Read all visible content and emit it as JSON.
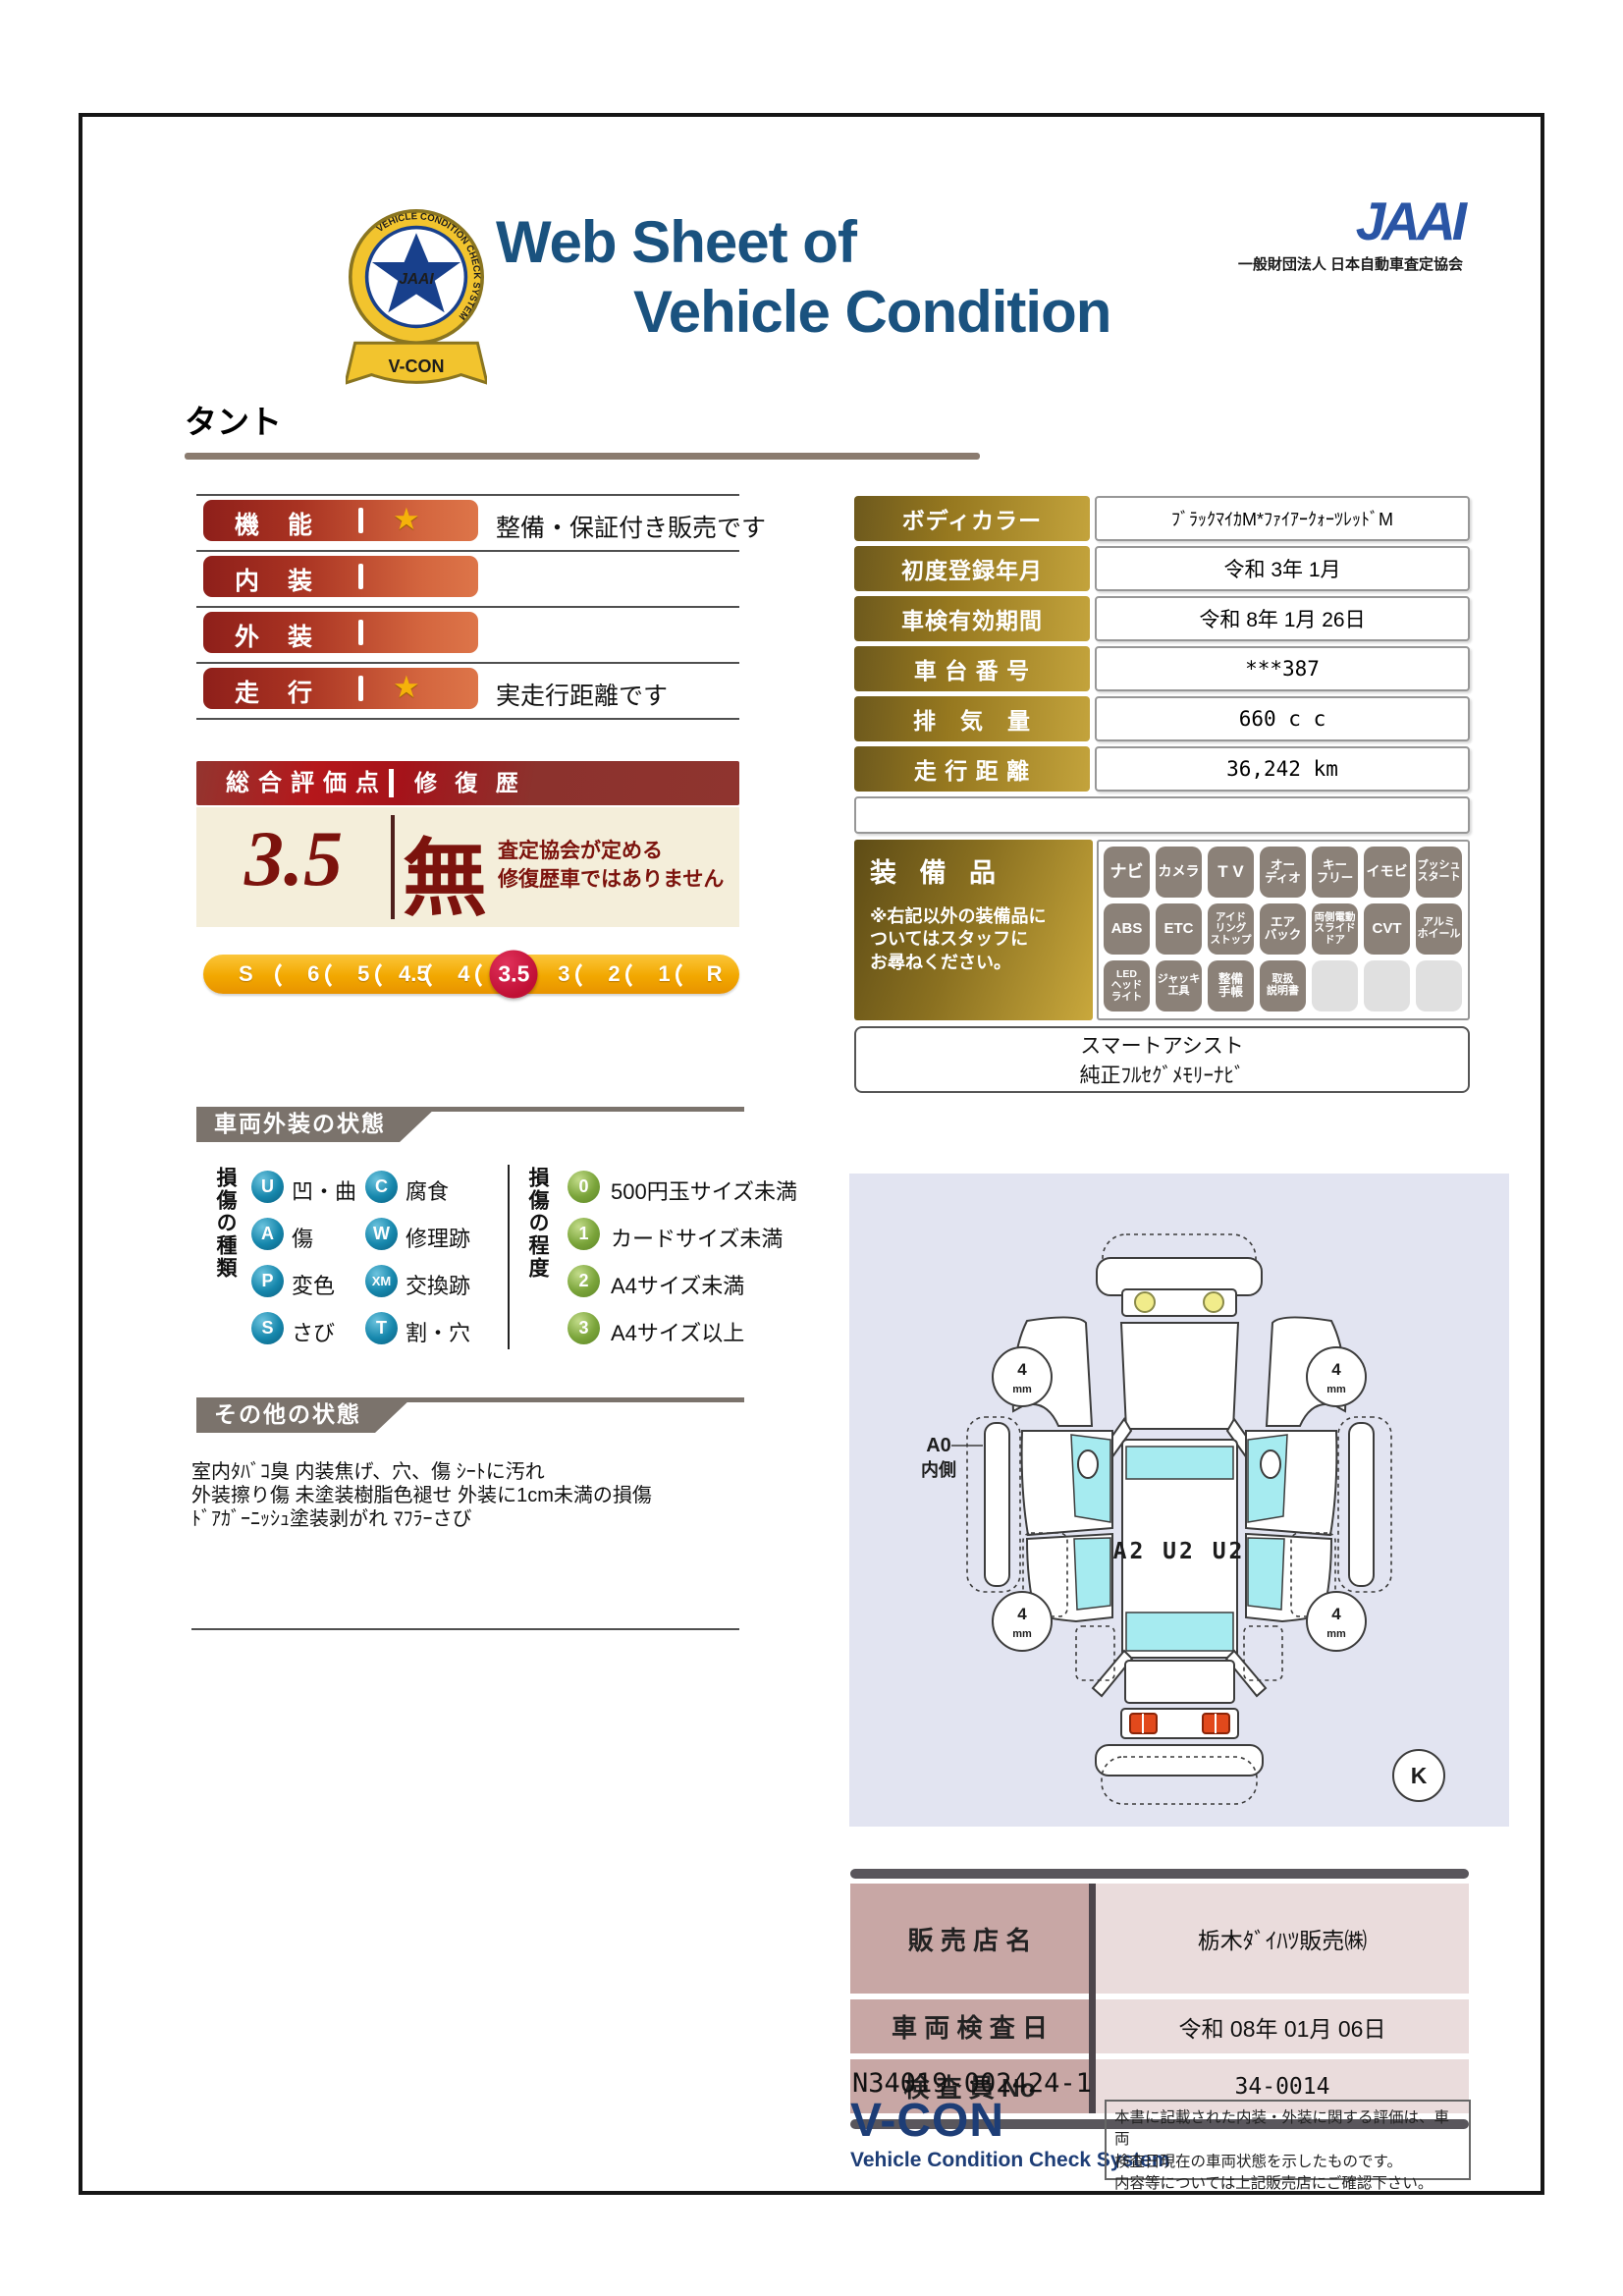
{
  "icons": {
    "star": "★"
  },
  "colors": {
    "title_navy": "#1a527f",
    "bar_red": "#a93322",
    "gold_label": "#96781f",
    "crimson_active": "#c00f35",
    "maroon_score": "#7c130d",
    "diagram_bg": "#e2e4f1",
    "flag_gray": "#7b736c"
  },
  "header": {
    "title_line1": "Web Sheet of",
    "title_line2": "Vehicle Condition",
    "emblem": {
      "ring_text": "VEHICLE CONDITION CHECK SYSTEM",
      "word": "JAAI",
      "ribbon": "V-CON"
    },
    "org_mark": "JAAI",
    "org_name": "一般財団法人 日本自動車査定協会"
  },
  "vehicle_name": "タント",
  "ratings": {
    "rows": [
      {
        "label": "機　能",
        "star": true,
        "note": "整備・保証付き販売です"
      },
      {
        "label": "内　装",
        "star": false,
        "note": ""
      },
      {
        "label": "外　装",
        "star": false,
        "note": ""
      },
      {
        "label": "走　行",
        "star": true,
        "note": "実走行距離です"
      }
    ]
  },
  "overall": {
    "header_left": "総合評価点",
    "header_right": "修 復 歴",
    "score": "3.5",
    "repair_mark": "無",
    "repair_note1": "査定協会が定める",
    "repair_note2": "修復歴車ではありません"
  },
  "scale": {
    "values": [
      "S",
      "6",
      "5",
      "4.5",
      "4",
      "3.5",
      "3",
      "2",
      "1",
      "R"
    ],
    "active": "3.5"
  },
  "info_table": {
    "rows": [
      {
        "label": "ボディカラー",
        "value": "ﾌﾞﾗｯｸﾏｲｶM*ﾌｧｲｱｰｸｫｰﾂﾚｯﾄﾞM"
      },
      {
        "label": "初度登録年月",
        "value": "令和 3年 1月"
      },
      {
        "label": "車検有効期間",
        "value": "令和 8年 1月 26日"
      },
      {
        "label": "車 台 番 号",
        "value": "***387"
      },
      {
        "label": "排　気　量",
        "value": "660 c c"
      },
      {
        "label": "走 行 距 離",
        "value": "36,242 km"
      }
    ]
  },
  "equipment": {
    "title": "装 備 品",
    "note": "※右記以外の装備品に\nついてはスタッフに\nお尋ねください。",
    "rows": [
      [
        "ナビ",
        "カメラ",
        "T V",
        "オー\nディオ",
        "キー\nフリー",
        "イモビ",
        "プッシュ\nスタート"
      ],
      [
        "ABS",
        "ETC",
        "アイド\nリング\nストップ",
        "エア\nバック",
        "両側電動\nスライド\nドア",
        "CVT",
        "アルミ\nホイール"
      ],
      [
        "LED\nヘッド\nライト",
        "ジャッキ\n工具",
        "整備\n手帳",
        "取扱\n説明書",
        "",
        "",
        ""
      ]
    ],
    "smart_line1": "スマートアシスト",
    "smart_line2": "純正ﾌﾙｾｸﾞﾒﾓﾘｰﾅﾋﾞ"
  },
  "exterior": {
    "title": "車両外装の状態",
    "type_header": "損傷の種類",
    "types": [
      {
        "code": "U",
        "label": "凹・曲"
      },
      {
        "code": "A",
        "label": "傷"
      },
      {
        "code": "P",
        "label": "変色"
      },
      {
        "code": "S",
        "label": "さび"
      },
      {
        "code": "C",
        "label": "腐食"
      },
      {
        "code": "W",
        "label": "修理跡"
      },
      {
        "code": "XM",
        "label": "交換跡"
      },
      {
        "code": "T",
        "label": "割・穴"
      }
    ],
    "degree_header": "損傷の程度",
    "degrees": [
      {
        "code": "0",
        "label": "500円玉サイズ未満"
      },
      {
        "code": "1",
        "label": "カードサイズ未満"
      },
      {
        "code": "2",
        "label": "A4サイズ未満"
      },
      {
        "code": "3",
        "label": "A4サイズ以上"
      }
    ]
  },
  "other": {
    "title": "その他の状態",
    "lines": [
      "室内ﾀﾊﾞｺ臭 内装焦げ、穴、傷 ｼｰﾄに汚れ",
      "外装擦り傷 未塗装樹脂色褪せ 外装に1cm未満の損傷",
      "ﾄﾞｱｶﾞｰﾆｯｼｭ塗装剥がれ ﾏﾌﾗｰさび"
    ]
  },
  "diagram": {
    "damage_text": "A2 U2 U2",
    "side_label1": "A0",
    "side_label2": "内側",
    "tire_value": "4",
    "tire_unit": "mm",
    "corner_mark": "K"
  },
  "dealer": {
    "rows": [
      {
        "label": "販 売 店 名",
        "value": "栃木ﾀﾞｲﾊﾂ販売㈱"
      },
      {
        "label": "車 両 検 査 日",
        "value": "令和 08年 01月 06日"
      },
      {
        "label": "検 査 員 No",
        "value": "34-0014"
      }
    ]
  },
  "footer": {
    "serial": "N34019-002424-1",
    "vcon": "V-CON",
    "vcon_sub": "Vehicle Condition Check System",
    "disclaimer": [
      "本書に記載された内装・外装に関する評価は、車両",
      "検査日現在の車両状態を示したものです。",
      "内容等については上記販売店にご確認下さい。"
    ]
  }
}
